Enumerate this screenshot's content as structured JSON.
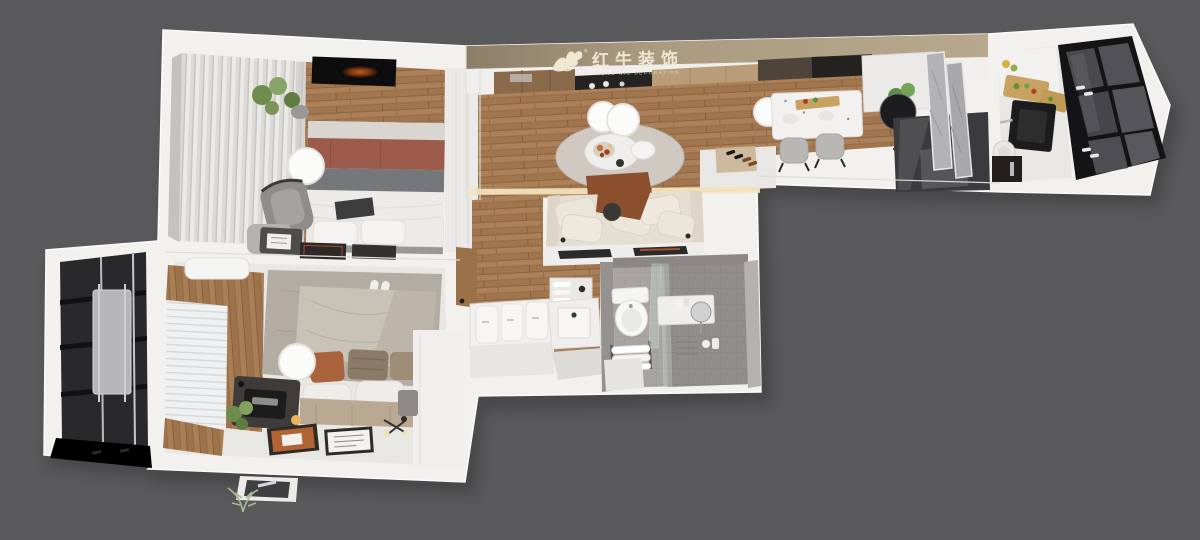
{
  "watermark": {
    "title": "红牛装饰",
    "subtitle": "HONG NIU DECORATION",
    "registered": "®",
    "logo": "bull-logo-icon"
  },
  "palette": {
    "background": "#59595b",
    "wall_white": "#f2f1ee",
    "wall_shade": "#dddcd9",
    "wood_floor": "#ac8058",
    "wood_wall": "#a97e55",
    "band_tan": "#a3927a",
    "glass_dark": "#2b2b2e",
    "window_frame_black": "#141416",
    "rug_gray": "#cfc9c2",
    "rug_taupe": "#b3aca3",
    "sofa_cream": "#e5dfd3",
    "bed_red_band": "#9b5a4a",
    "bed_gray_band": "#75777a",
    "accent_rust": "#a85c3a",
    "plant_green": "#6f8c4f",
    "tile_gray": "#a8a5a1"
  },
  "scene": {
    "type": "3d-floorplan-render",
    "rooms": [
      "balcony-left",
      "bedroom-secondary",
      "bedroom-master",
      "hallway",
      "bathroom",
      "living-room",
      "dining-area",
      "kitchen",
      "window-bay-right"
    ]
  }
}
